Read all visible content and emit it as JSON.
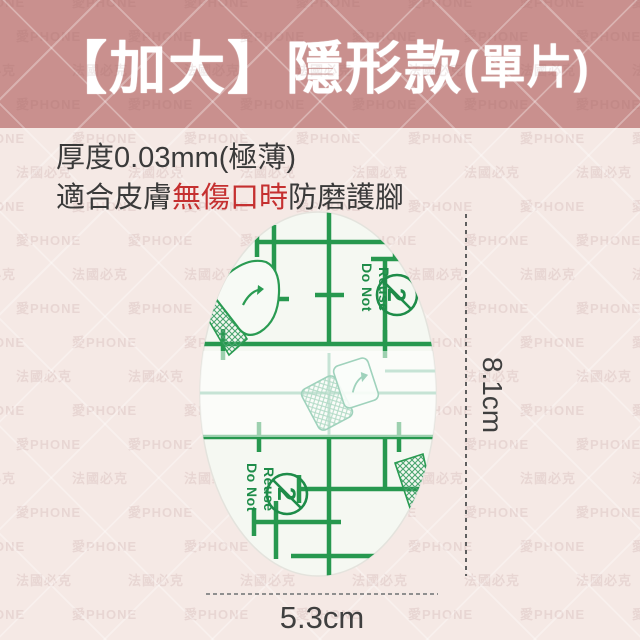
{
  "header": {
    "title_main": "【加大】隱形款",
    "title_sub": "(單片)"
  },
  "description": {
    "line1": "厚度0.03mm(極薄)",
    "line2_prefix": "適合皮膚",
    "line2_highlight": "無傷口時",
    "line2_suffix": "防磨護腳"
  },
  "patch": {
    "warning_line1": "Do Not",
    "warning_line2": "Reuse",
    "icon_glyph": "2"
  },
  "dimensions": {
    "height": "8.1cm",
    "width": "5.3cm"
  },
  "watermark": {
    "line1": "愛PHONE",
    "line2": "法國必克"
  },
  "colors": {
    "header_bg": "#c9908e",
    "body_bg": "#f5e9e5",
    "grid_green": "#27984f",
    "highlight_red": "#c53030",
    "text_dark": "#3a3a3a"
  }
}
